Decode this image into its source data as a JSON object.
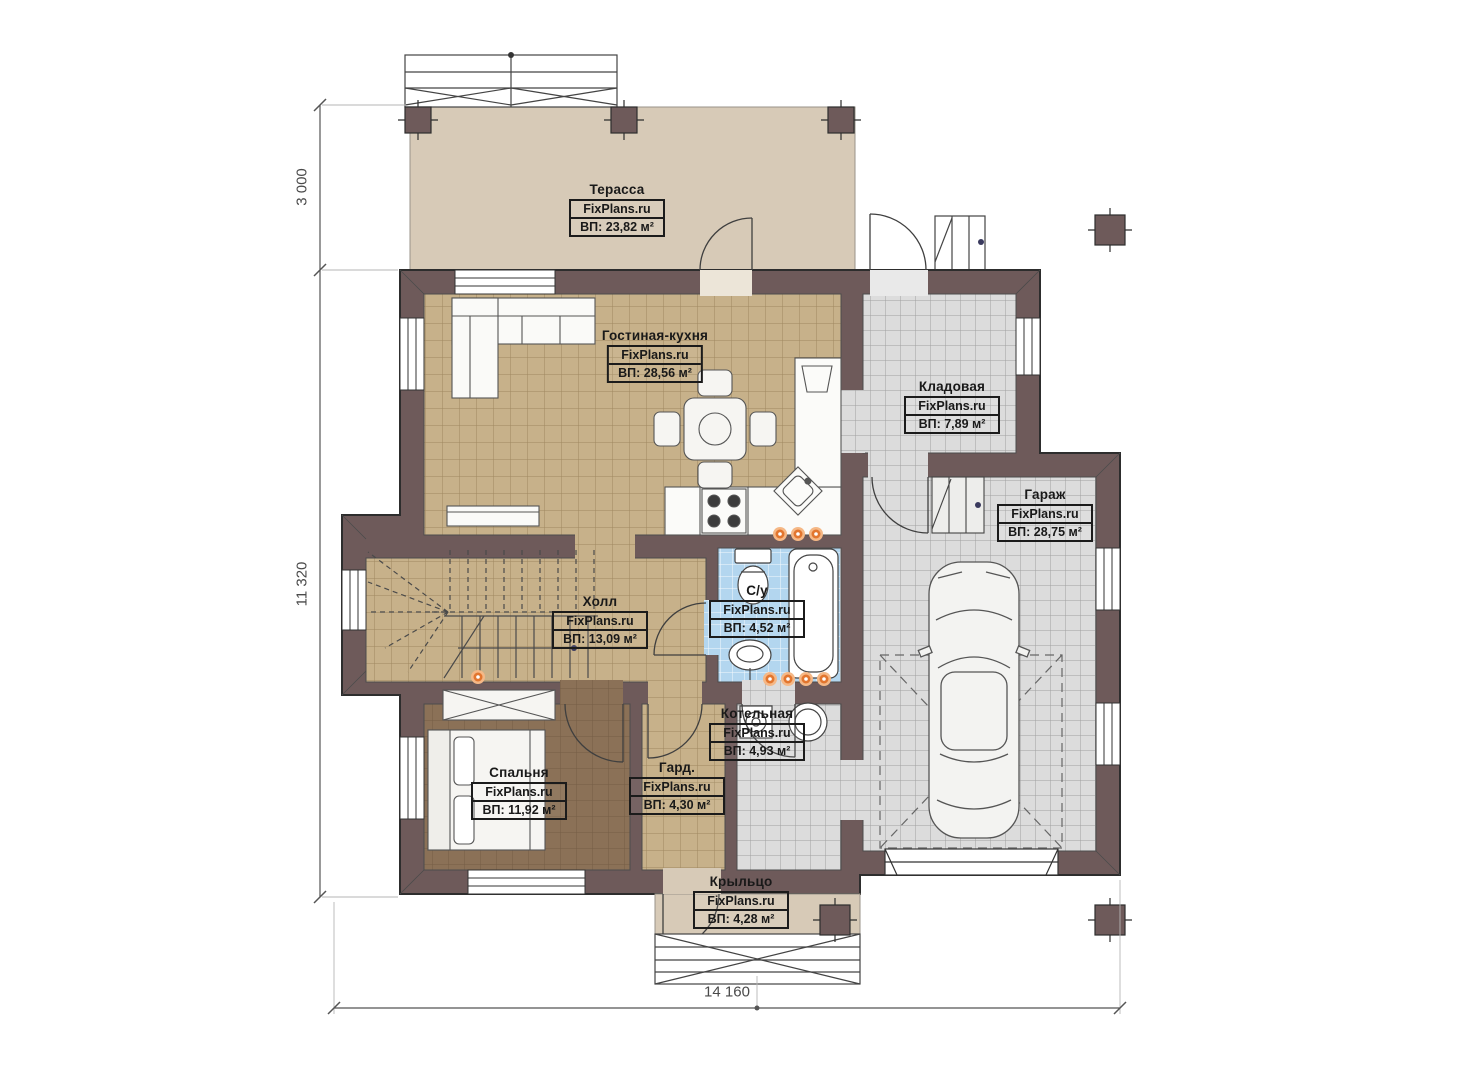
{
  "brand": "FixPlans.ru",
  "rooms": [
    {
      "name": "Терасса",
      "area": "ВП: 23,82 м²"
    },
    {
      "name": "Гостиная-кухня",
      "area": "ВП: 28,56 м²"
    },
    {
      "name": "Кладовая",
      "area": "ВП: 7,89 м²"
    },
    {
      "name": "Гараж",
      "area": "ВП: 28,75 м²"
    },
    {
      "name": "Холл",
      "area": "ВП: 13,09 м²"
    },
    {
      "name": "С/у",
      "area": "ВП: 4,52 м²"
    },
    {
      "name": "Котельная",
      "area": "ВП: 4,93 м²"
    },
    {
      "name": "Гард.",
      "area": "ВП: 4,30 м²"
    },
    {
      "name": "Спальня",
      "area": "ВП: 11,92 м²"
    },
    {
      "name": "Крыльцо",
      "area": "ВП: 4,28 м²"
    }
  ],
  "dimensions": {
    "left_top": "3 000",
    "left_side": "11 320",
    "bottom": "14 160"
  },
  "colors": {
    "wall": "#6e5a5a",
    "terrace": "#d7cab7",
    "tile_tan": "#c7b18a",
    "tile_gray": "#dcdcdc",
    "tile_blue": "#b3d6ef",
    "bedroom_floor": "#8b7157",
    "heating_dot": "#e2762f"
  }
}
